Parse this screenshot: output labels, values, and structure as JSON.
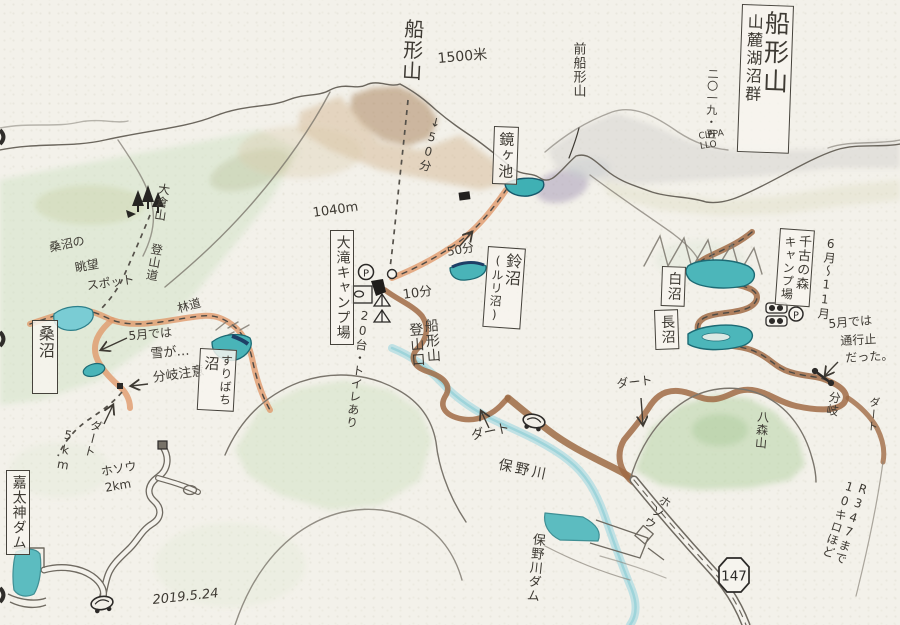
{
  "map": {
    "title": {
      "main": "船形山",
      "sub": "山麓湖沼群",
      "side_date": "二〇一九・五",
      "signature": "CIPPA LLO"
    },
    "peaks": {
      "funagata": "船形山",
      "funagata_elevation": "1500米",
      "mae_funagata": "前船形山",
      "okurayama": "大倉山",
      "hachimoriyama": "八森山"
    },
    "waters": {
      "kagamigaike": "鏡ヶ池",
      "suzunuma": "鈴沼",
      "suzunuma_alt": "(ルリ沼)",
      "shiranuma": "白沼",
      "naganuma": "長沼",
      "suribachi_main": "すりばち",
      "suribachi_suffix": "沼",
      "kuwanuma": "桑沼",
      "honogawa_river": "保野川",
      "hono_dam": "保野川ダム",
      "kadaijin_dam": "嘉太神ダム"
    },
    "facilities": {
      "otaki_camp": "大滝キャンプ場",
      "otaki_parking_note": "20台・トイレあり",
      "senko_forest": "千古の森",
      "senko_camp": "キャンプ場",
      "senko_season": "6月〜11月",
      "trailhead_line1": "船形山",
      "trailhead_line2": "登山口",
      "parking_letter": "P"
    },
    "trails": {
      "tozando": "登山道",
      "rindo": "林道",
      "time_50min_down": "↓50分",
      "time_50min": "50分",
      "time_10min": "10分",
      "elevation_1040": "1040m",
      "viewpoint_line1": "桑沼の",
      "viewpoint_line2": "眺望",
      "viewpoint_line3": "スポット"
    },
    "roads": {
      "dirt_west": "ダート",
      "dirt_center": "ダート",
      "dirt_switchback": "ダート",
      "dirt_right_edge": "ダート",
      "paved_left_1": "ホソウ",
      "paved_left_2": "2km",
      "paved_right": "ホソウ",
      "dist_5km": "5km",
      "route_147": "147",
      "r347_line1": "R347まで",
      "r347_line2": "10キロほど"
    },
    "notes": {
      "may_snow_1": "5月では",
      "may_snow_2": "雪が…",
      "branch_caution": "分岐注意",
      "may_closed_1": "5月では",
      "may_closed_2": "通行止",
      "may_closed_3": "だった。",
      "branch": "分岐"
    },
    "date_note": "2019.5.24",
    "palette": {
      "ink": "#3e3a33",
      "pond_teal": "#4cb6ba",
      "river_blue": "#b3dde2",
      "forest_road_orange": "#e09a6c",
      "dirt_road_brown": "#a06b45",
      "hill_green": "#cfe2c2"
    }
  }
}
